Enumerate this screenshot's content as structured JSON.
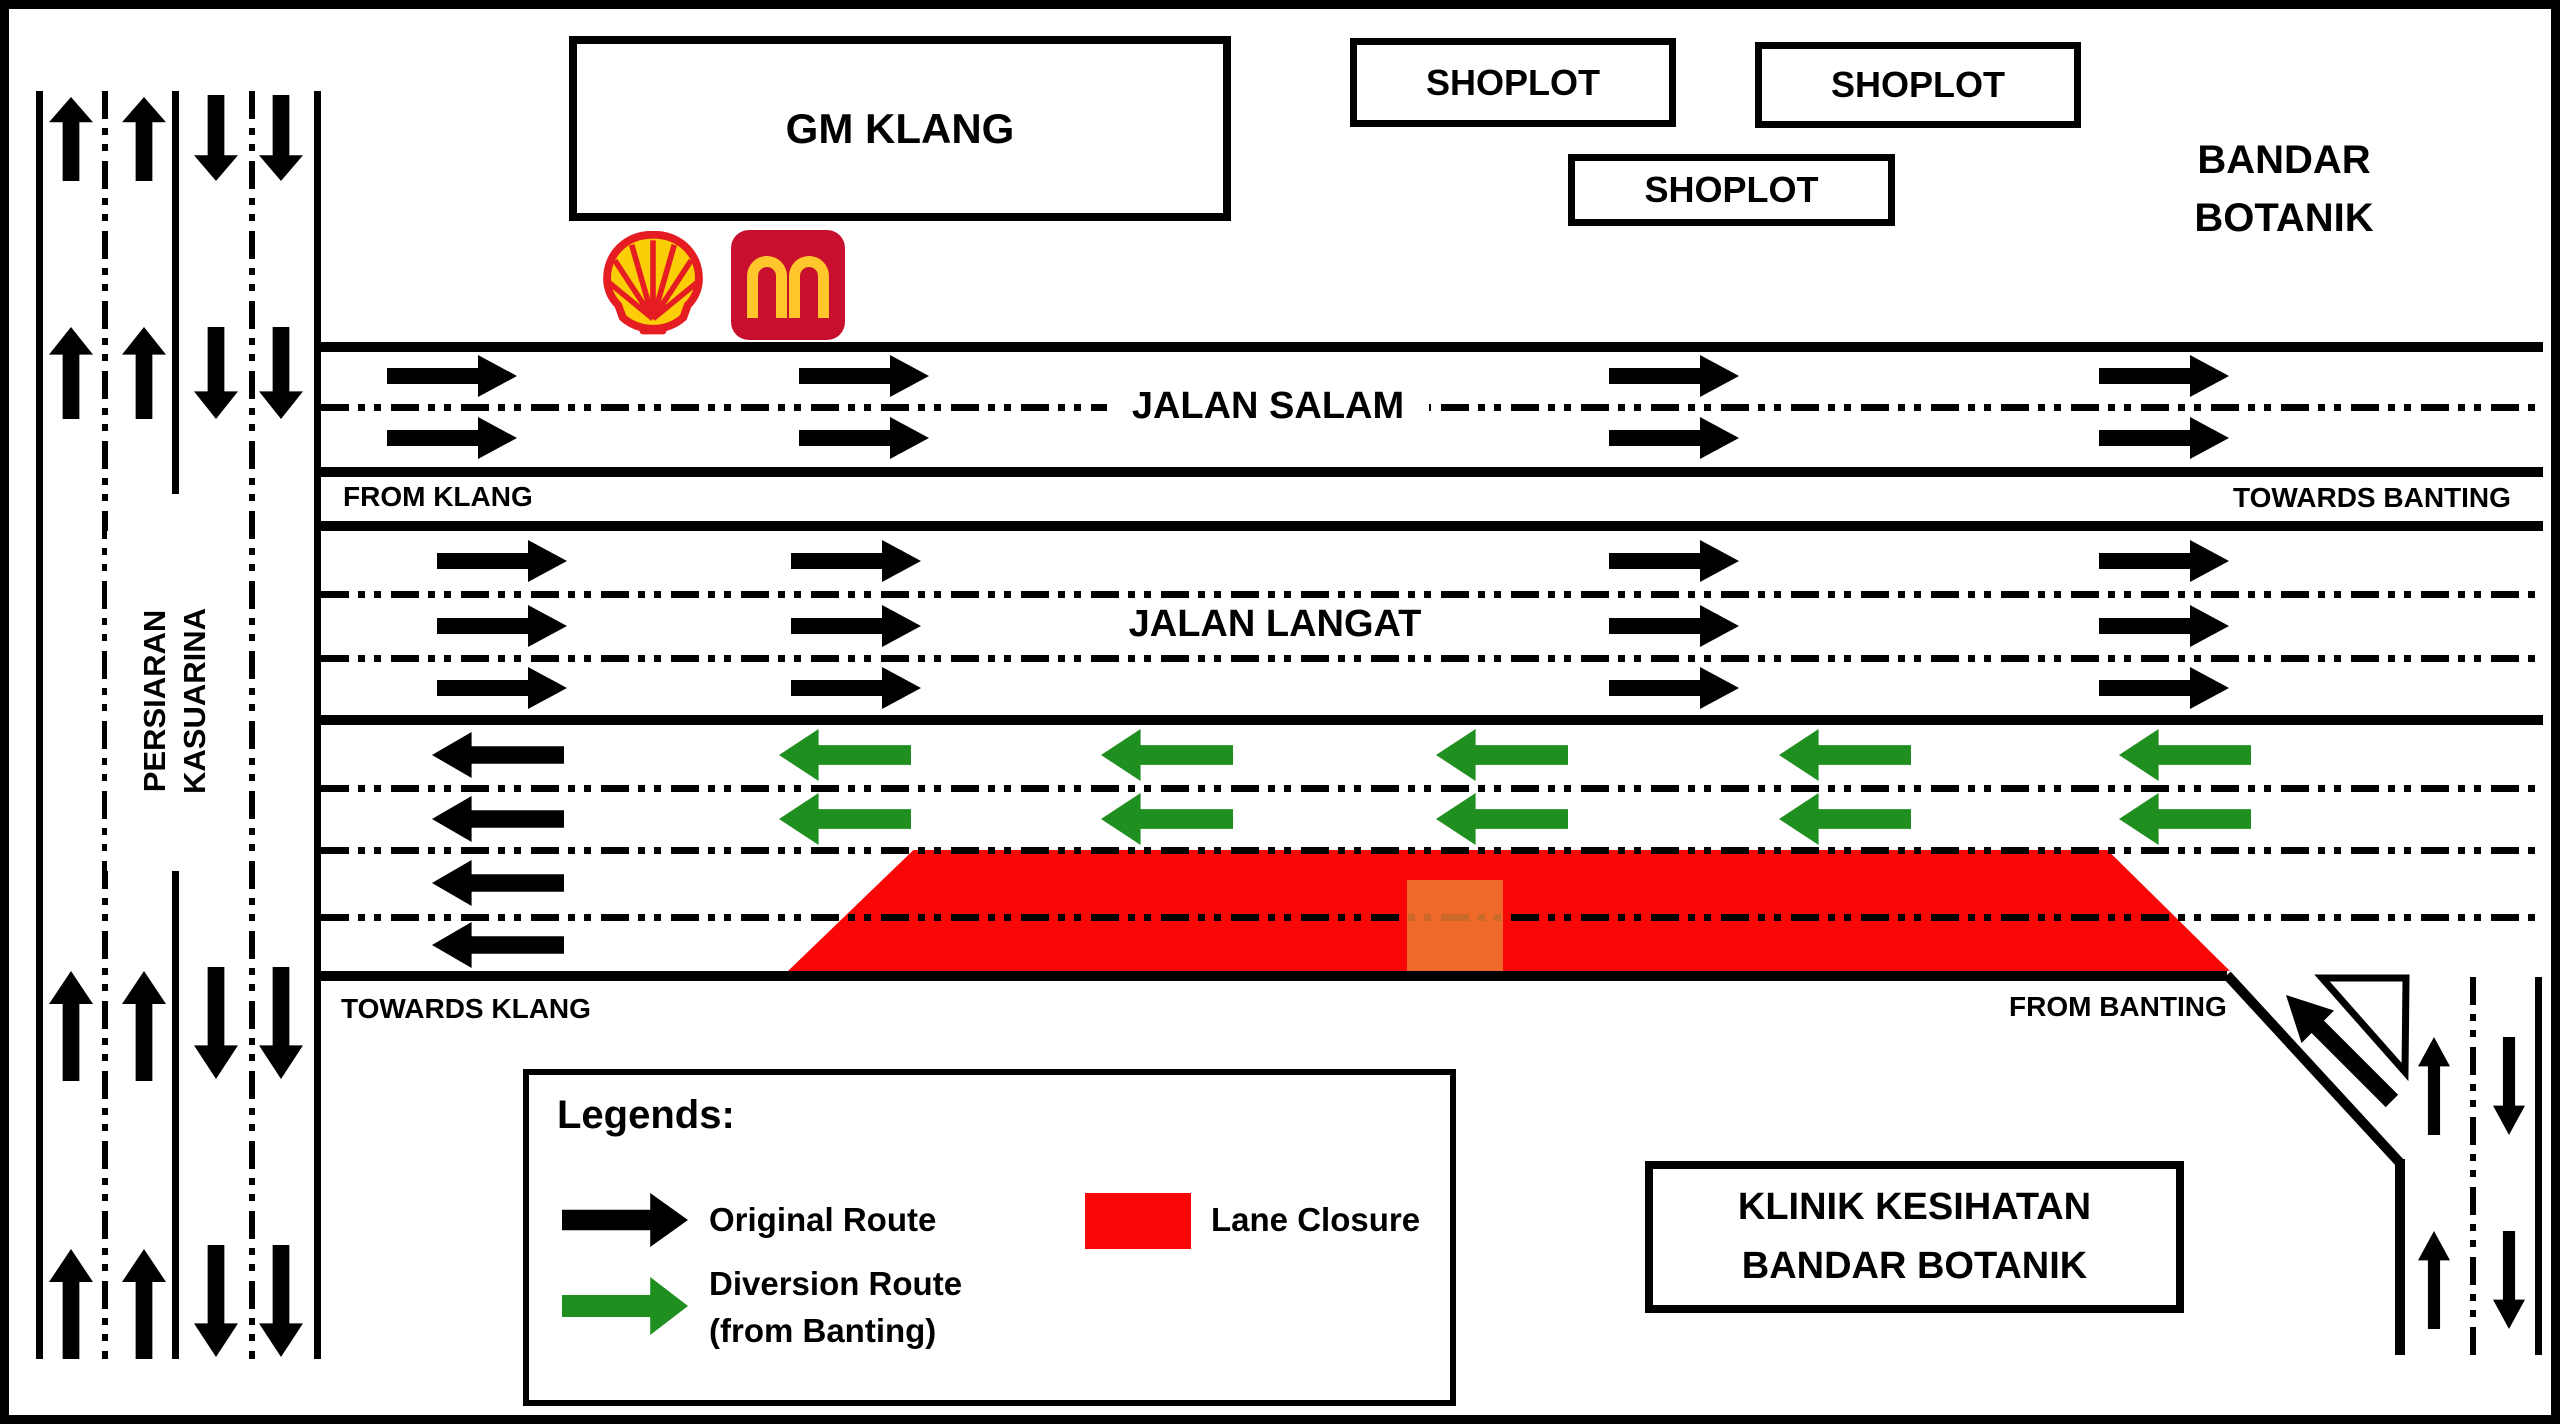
{
  "title": "Jalan Langat lane closure and traffic diversion plan",
  "buildings": {
    "gm_klang": "GM KLANG",
    "shoplots": [
      "SHOPLOT",
      "SHOPLOT",
      "SHOPLOT"
    ],
    "klinik_line1": "KLINIK KESIHATAN",
    "klinik_line2": "BANDAR BOTANIK",
    "area_line1": "BANDAR",
    "area_line2": "BOTANIK"
  },
  "roads": {
    "jalan_salam": "JALAN SALAM",
    "jalan_langat": "JALAN LANGAT",
    "persiaran_line1": "PERSIARAN",
    "persiaran_line2": "KASUARINA"
  },
  "directions": {
    "from_klang": "FROM KLANG",
    "towards_banting": "TOWARDS BANTING",
    "towards_klang": "TOWARDS KLANG",
    "from_banting": "FROM BANTING"
  },
  "legend": {
    "title": "Legends:",
    "original_route": "Original Route",
    "diversion_route_line1": "Diversion Route",
    "diversion_route_line2": "(from Banting)",
    "lane_closure": "Lane Closure"
  },
  "icons": {
    "shell": "shell-pecten-logo",
    "mcdonalds": "golden-arches-logo"
  },
  "colors": {
    "original_route": "#000000",
    "diversion_route": "#1F8F1F",
    "lane_closure": "#F90606",
    "work_zone_patch": "#ED7D31",
    "shell_red": "#E61C23",
    "shell_yellow": "#FBCE07",
    "mcd_red": "#C8102E",
    "mcd_yellow": "#FFC72C"
  }
}
